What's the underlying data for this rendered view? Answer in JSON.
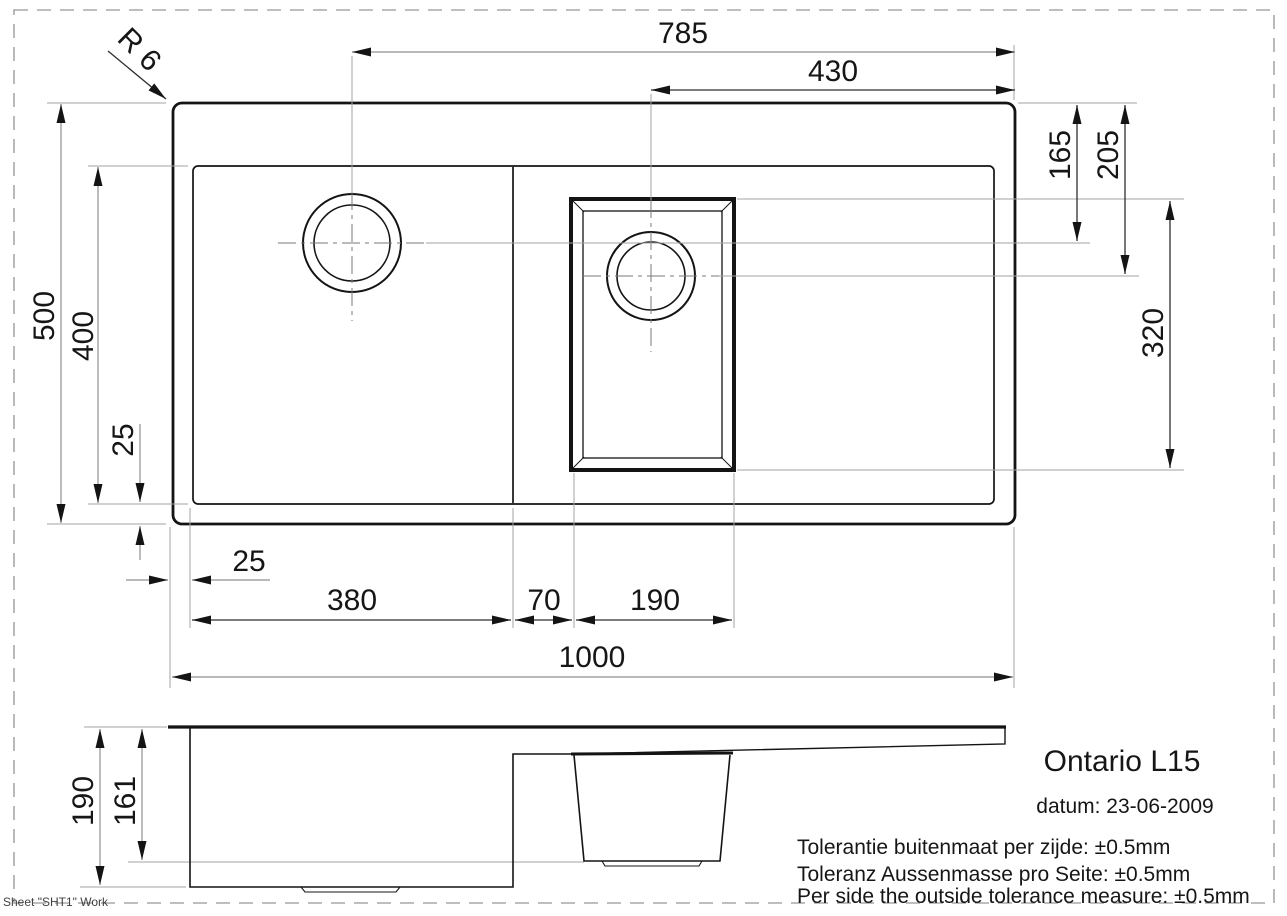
{
  "drawing_type": "technical-drawing",
  "colors": {
    "background": "#ffffff",
    "outline": "#141414",
    "dimension_dark": "#2e2e2e",
    "dimension_gray": "#8f8f8f",
    "extension_line": "#a3a3a3",
    "page_border": "#a8a8a8"
  },
  "dims": {
    "d785": "785",
    "d430": "430",
    "d500": "500",
    "d400": "400",
    "d25_side": "25",
    "d25_bottom": "25",
    "d380": "380",
    "d70": "70",
    "d190_top": "190",
    "d1000": "1000",
    "d165": "165",
    "d205": "205",
    "d320": "320",
    "d190_depth": "190",
    "d161": "161",
    "r6": "R 6"
  },
  "title_block": {
    "product_name": "Ontario L15",
    "date_line": "datum: 23-06-2009",
    "tolerance_lines": [
      "Tolerantie buitenmaat per zijde: ±0.5mm",
      "Toleranz Aussenmasse pro Seite: ±0.5mm",
      "Per side the outside tolerance measure: ±0.5mm"
    ]
  },
  "sheet_label": "Sheet \"SHT1\" Work"
}
